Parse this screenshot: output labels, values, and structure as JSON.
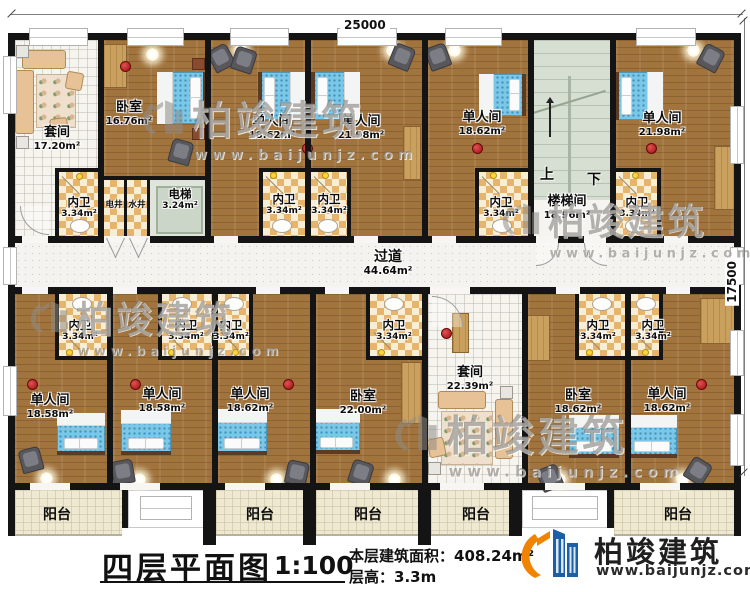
{
  "dimensions": {
    "width_mm": "25000",
    "height_mm": "17500"
  },
  "corridor": {
    "name": "过道",
    "area": "44.64m²"
  },
  "stairwell": {
    "name": "楼梯间",
    "area": "18.96m²",
    "up": "上",
    "down": "下"
  },
  "elevator": {
    "name": "电梯",
    "area": "3.24m²"
  },
  "shafts": {
    "electric": "电井",
    "water": "水井"
  },
  "rooms_upper": [
    {
      "name": "套间",
      "area": "17.20m²"
    },
    {
      "name": "卧室",
      "area": "16.76m²"
    },
    {
      "name": "单人间",
      "area": "18.62m²"
    },
    {
      "name": "单人间",
      "area": "21.98m²"
    },
    {
      "name": "单人间",
      "area": "18.62m²"
    },
    {
      "name": "单人间",
      "area": "21.98m²"
    }
  ],
  "rooms_lower": [
    {
      "name": "单人间",
      "area": "18.58m²"
    },
    {
      "name": "单人间",
      "area": "18.58m²"
    },
    {
      "name": "单人间",
      "area": "18.62m²"
    },
    {
      "name": "卧室",
      "area": "22.00m²"
    },
    {
      "name": "套间",
      "area": "22.39m²"
    },
    {
      "name": "卧室",
      "area": "18.62m²"
    },
    {
      "name": "单人间",
      "area": "18.62m²"
    }
  ],
  "bathroom": {
    "name": "内卫",
    "area": "3.34m²"
  },
  "balcony_label": "阳台",
  "watermark": {
    "brand": "柏竣建筑",
    "url": "www.baijunjz.com"
  },
  "title_block": {
    "title": "四层平面图",
    "scale": "1:100",
    "area_label": "本层建筑面积：",
    "area_value": "408.24m²",
    "height_label": "层高：",
    "height_value": "3.3m",
    "brand": "柏竣建筑",
    "brand_url": "www.baijunjz.com"
  }
}
